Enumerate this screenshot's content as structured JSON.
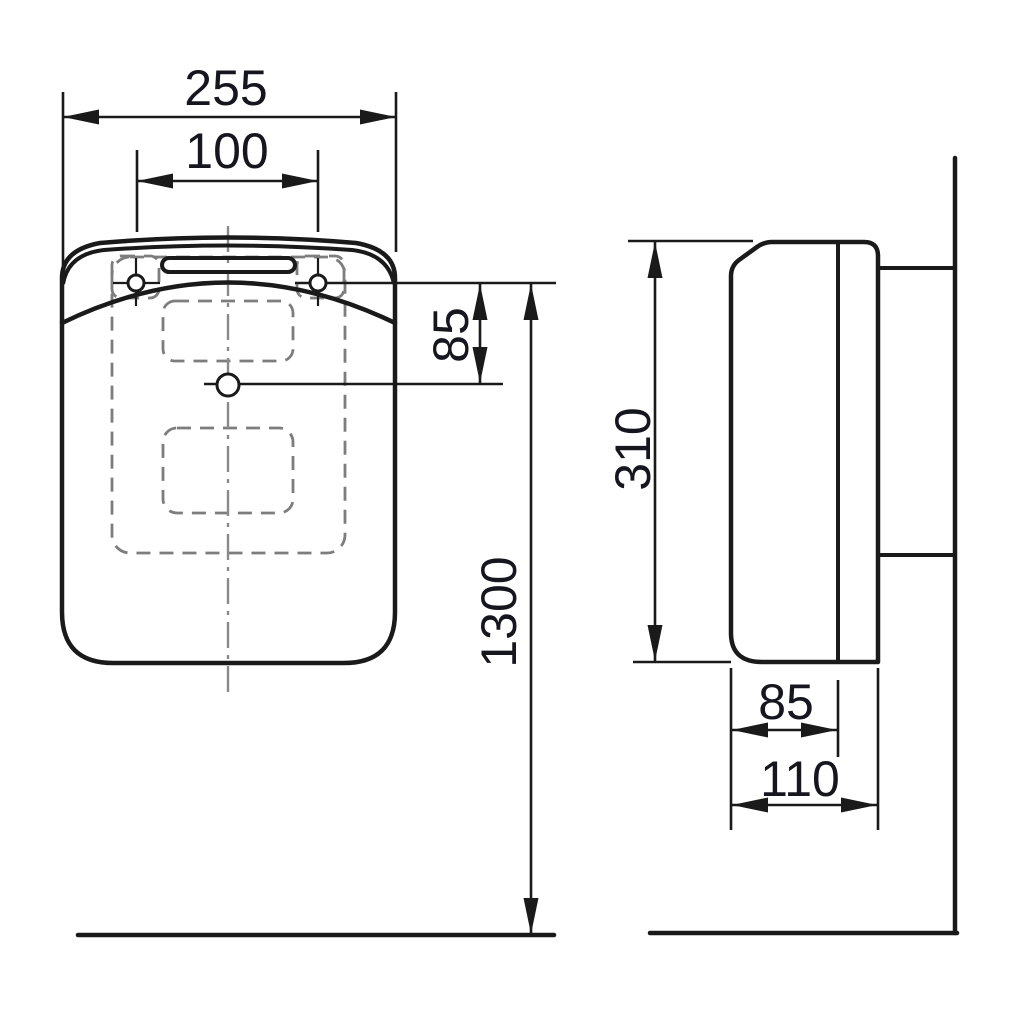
{
  "drawing": {
    "kind": "installation dimension drawing, front and side view",
    "front_view": {
      "dim_overall_width": "255",
      "dim_hole_spacing": "100",
      "dim_holes_to_outlet": "85",
      "dim_mounting_height": "1300"
    },
    "side_view": {
      "dim_body_height": "310",
      "dim_depth_to_seam": "85",
      "dim_overall_depth": "110"
    },
    "colors": {
      "line": "#1a1a1a",
      "hidden_line": "#7d7d7d",
      "center_line": "#8a8a8a",
      "text": "#16161e",
      "background": "#ffffff"
    }
  }
}
